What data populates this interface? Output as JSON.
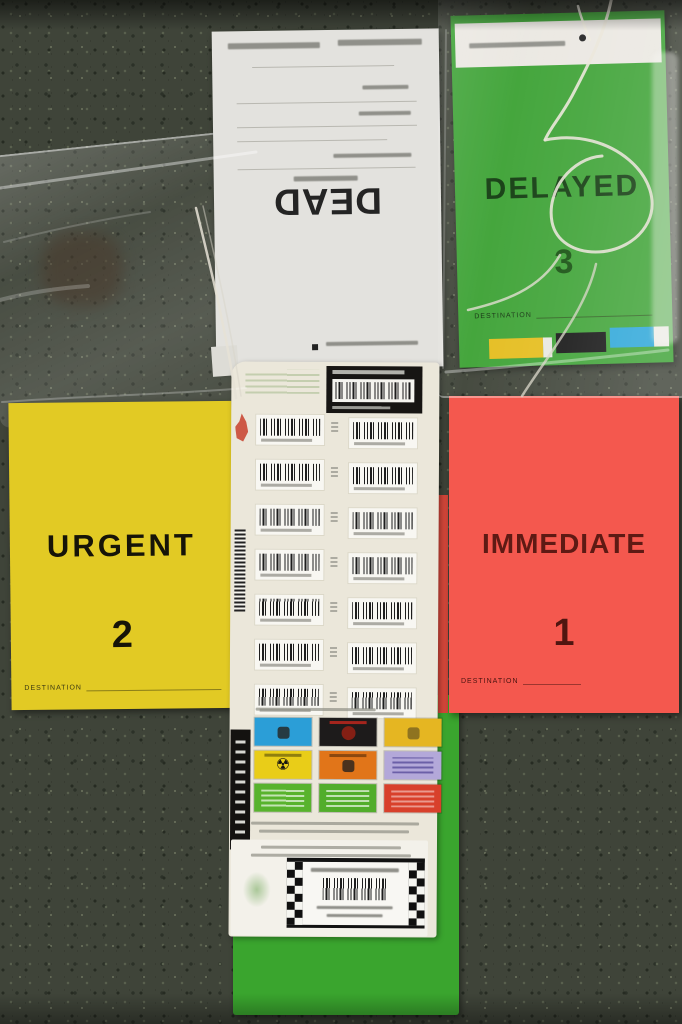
{
  "scene": {
    "type": "photograph",
    "subject": "Mass-casualty triage tag kit laid out on dark speckled floor"
  },
  "dead_card": {
    "title": "DEAD",
    "color": "#e3e2de"
  },
  "delayed_tag": {
    "title": "DELAYED",
    "number": "3",
    "destination_label": "DESTINATION",
    "color": "#3ea336",
    "tab_colors": {
      "left": "#e5bd1d",
      "middle": "#141414",
      "right": "#2ba6d9"
    }
  },
  "urgent_tag": {
    "title": "URGENT",
    "number": "2",
    "destination_label": "DESTINATION",
    "color": "#e2ca24"
  },
  "immediate_tag": {
    "title": "IMMEDIATE",
    "number": "1",
    "destination_label": "DESTINATION",
    "color": "#f4584e"
  },
  "green_card": {
    "color": "#3aa52e"
  },
  "barcode_sheet": {
    "color": "#ebe7da",
    "barcode_pair_rows": 7,
    "hazard_stickers": [
      {
        "name": "blue-hazard-sticker",
        "color": "#2b9ed7"
      },
      {
        "name": "black-hazard-sticker",
        "color": "#1d1b1b"
      },
      {
        "name": "amber-hazard-sticker",
        "color": "#e5b622"
      },
      {
        "name": "radiation-sticker",
        "color": "#e9cd18",
        "glyph": "☢"
      },
      {
        "name": "orange-hazard-sticker",
        "color": "#e17519"
      },
      {
        "name": "lavender-hazard-sticker",
        "color": "#b3a8d9"
      },
      {
        "name": "green-info-sticker",
        "color": "#58b32d"
      },
      {
        "name": "green-info-sticker-2",
        "color": "#52ad2b"
      },
      {
        "name": "red-info-sticker",
        "color": "#d8402b"
      }
    ]
  }
}
